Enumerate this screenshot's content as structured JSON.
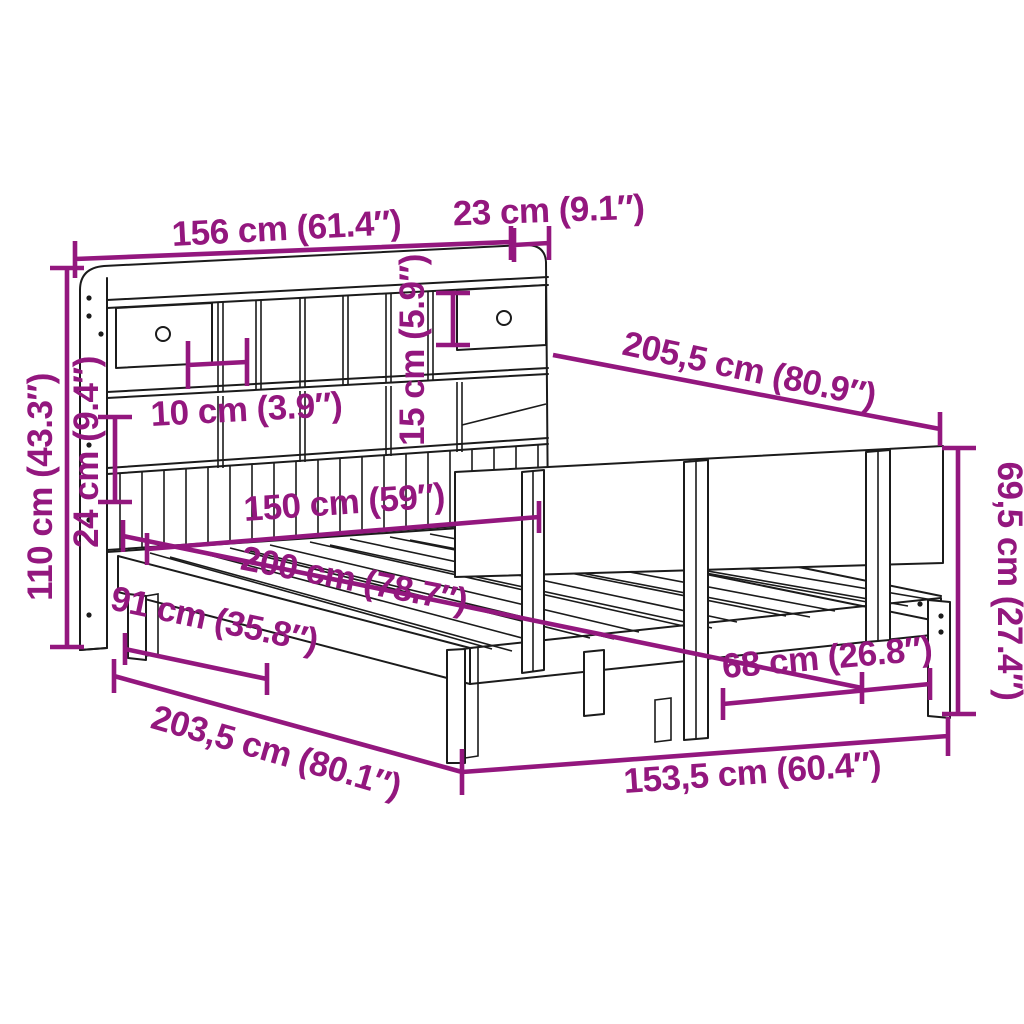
{
  "diagram": {
    "description": "Bookcase bed frame with headboard shelves, two drawers and side rail — dimension drawing",
    "accent_color": "#93177e",
    "line_color": "#1b1b1b",
    "background_color": "#ffffff",
    "dimensions": {
      "headboard_width": {
        "label": "156 cm (61.4″)"
      },
      "headboard_depth": {
        "label": "23 cm (9.1″)"
      },
      "total_length": {
        "label": "205,5 cm (80.9″)"
      },
      "total_height": {
        "label": "110 cm (43.3″)"
      },
      "lower_panel_height": {
        "label": "24 cm (9.4″)"
      },
      "compartment_width": {
        "label": "10 cm (3.9″)"
      },
      "drawer_height": {
        "label": "15 cm (5.9″)"
      },
      "inner_width": {
        "label": "150 cm (59″)"
      },
      "sleeping_length": {
        "label": "200 cm (78.7″)"
      },
      "side_length": {
        "label": "91 cm (35.8″)"
      },
      "base_length": {
        "label": "203,5 cm (80.1″)"
      },
      "base_width": {
        "label": "153,5 cm (60.4″)"
      },
      "foot_gap": {
        "label": "68 cm (26.8″)"
      },
      "rail_height": {
        "label": "69,5 cm (27.4″)"
      }
    }
  }
}
